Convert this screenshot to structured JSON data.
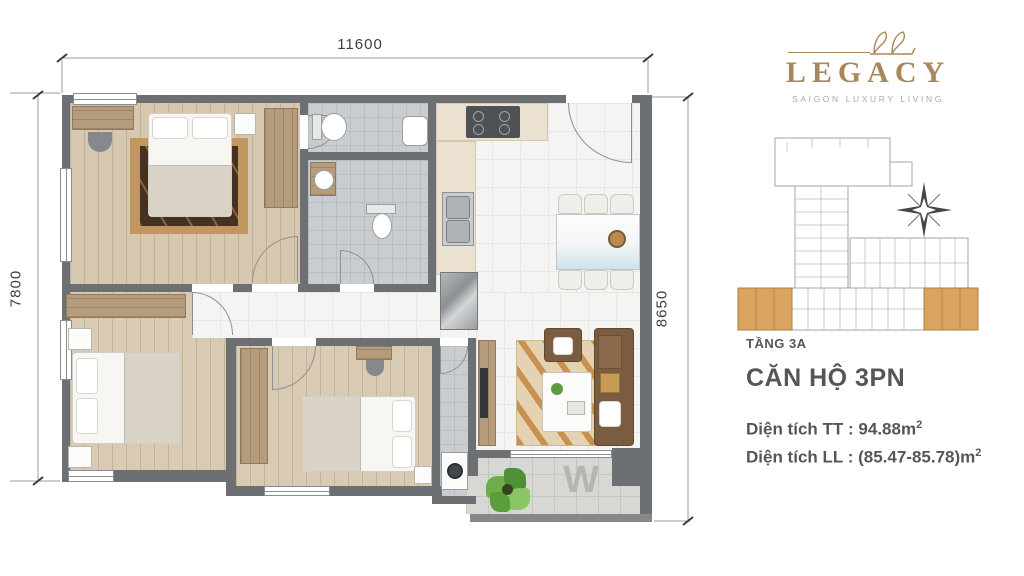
{
  "plan": {
    "dim_top": "11600",
    "dim_left": "7800",
    "dim_right": "8650",
    "balcony_window_mark": "W"
  },
  "brand": {
    "name": "LEGACY",
    "tagline": "SAIGON LUXURY LIVING"
  },
  "key_plan": {
    "floor_label": "TẦNG 3A"
  },
  "unit": {
    "title": "CĂN HỘ 3PN",
    "area_tt_label": "Diện tích TT :",
    "area_tt_value": "94.88m",
    "area_ll_label": "Diện tích LL :",
    "area_ll_value": "(85.47-85.78)m",
    "superscript": "2"
  },
  "colors": {
    "brand_gold": "#a8875a",
    "heading_text": "#55565a",
    "wall": "#6d7073",
    "keyplan_highlight": "#d9a45f",
    "wood_floor": "#d6c7b0",
    "bath_tile": "#c9cdcf"
  }
}
